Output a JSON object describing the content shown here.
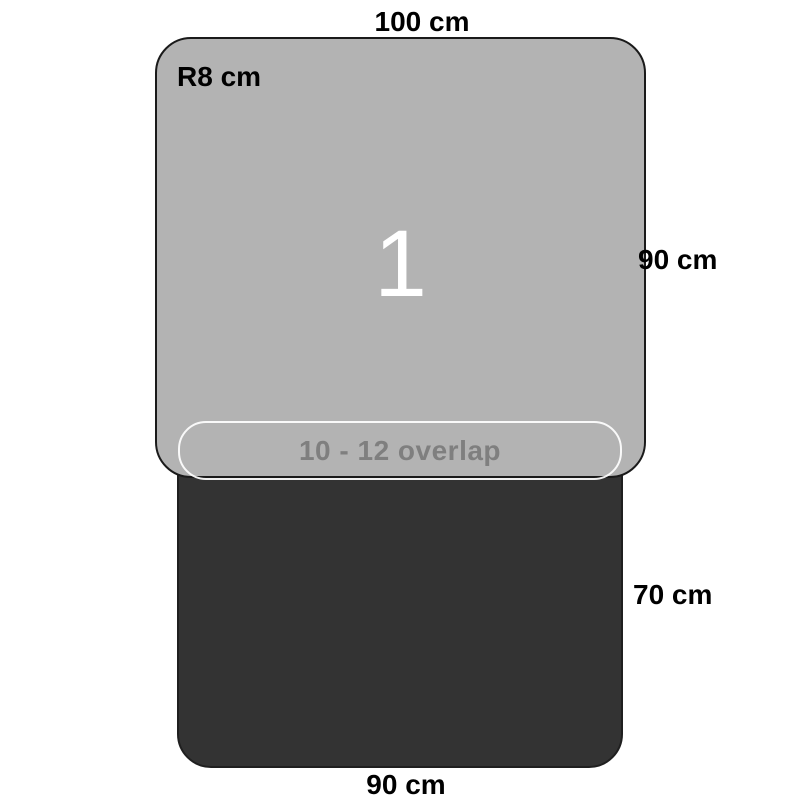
{
  "diagram": {
    "type": "dimension-diagram",
    "mats": {
      "mat1": {
        "number": "1",
        "width_label": "100 cm",
        "height_label": "90 cm",
        "corner_radius_label": "R8 cm",
        "fill_color": "#b3b3b3"
      },
      "mat2": {
        "width_label": "90 cm",
        "height_label": "70 cm",
        "fill_color": "#333333"
      },
      "overlap": {
        "label": "10 - 12 overlap",
        "outline_color": "#ffffff",
        "text_color": "#7f7f7f"
      }
    },
    "colors": {
      "background": "#ffffff",
      "outline": "#1a1a1a",
      "dimension_text": "#000000",
      "mat1_number_text": "#ffffff"
    }
  }
}
